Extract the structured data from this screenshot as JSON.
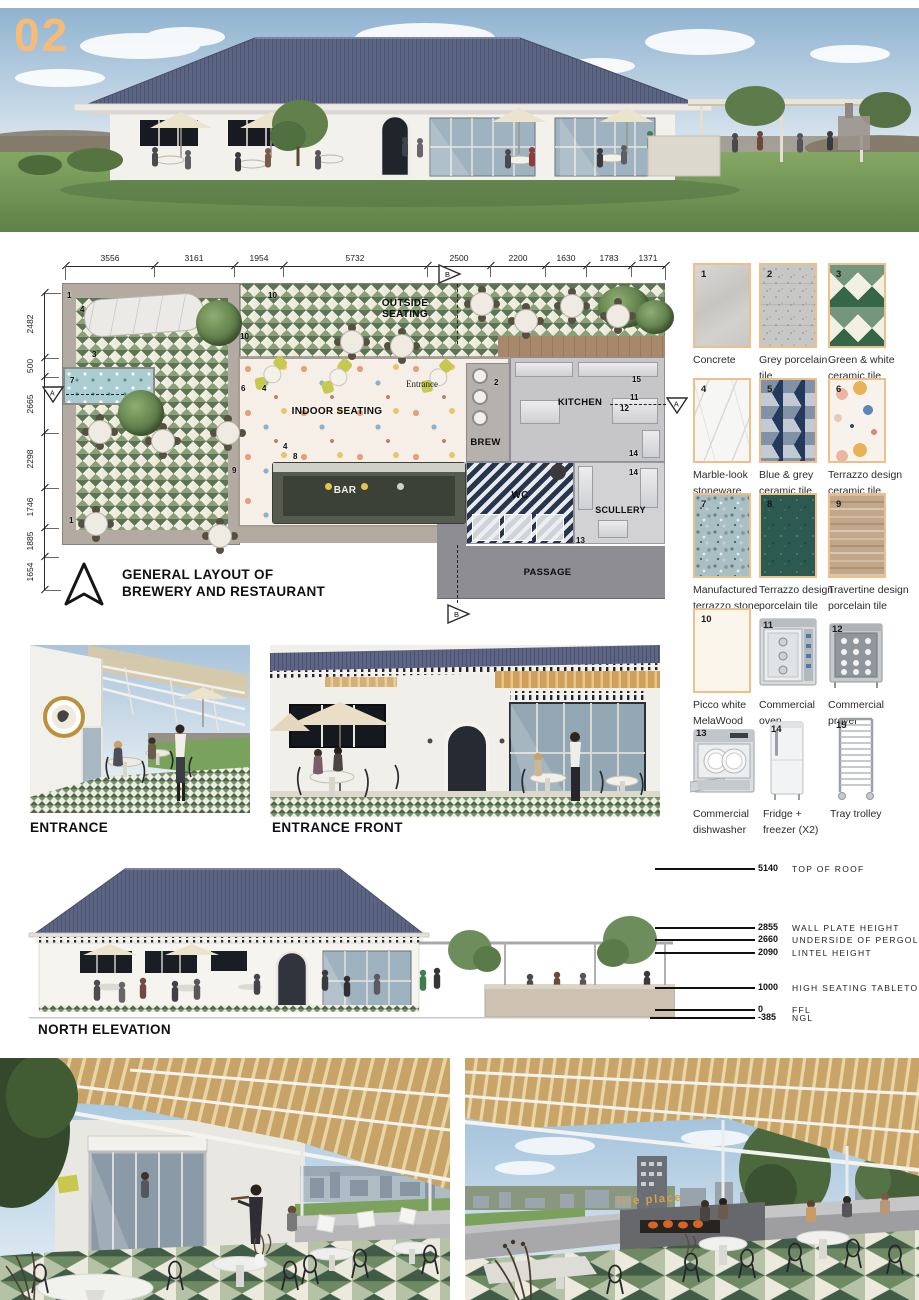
{
  "page": {
    "number": "02"
  },
  "colors": {
    "accent_orange": "#f6bb79",
    "swatch_border": "#ecbf8d",
    "roof_blue": "#5d6584",
    "tile_green": "#74906b",
    "gold_sign": "#d9a045"
  },
  "icons": {
    "north_arrow": "north-arrow-icon",
    "section_marker": "section-flag-icon"
  },
  "plan": {
    "title1": "GENERAL LAYOUT OF",
    "title2": "BREWERY AND RESTAURANT",
    "dims_top": [
      "3556",
      "3161",
      "1954",
      "5732",
      "2500",
      "2200",
      "1630",
      "1783",
      "1371"
    ],
    "dims_left": [
      "2482",
      "500",
      "2665",
      "2298",
      "1746",
      "1885",
      "1654"
    ],
    "labels": {
      "outside1": "OUTSIDE",
      "outside2": "SEATING",
      "indoor": "INDOOR SEATING",
      "bar": "BAR",
      "entrance": "Entrance",
      "brew": "BREW",
      "kitchen": "KITCHEN",
      "wc": "WC",
      "scullery": "SCULLERY",
      "passage": "PASSAGE"
    },
    "section_a": "A",
    "section_b": "B",
    "markers": [
      "1",
      "4",
      "3",
      "7",
      "10",
      "10",
      "6",
      "4",
      "9",
      "1",
      "4",
      "8",
      "2",
      "15",
      "11",
      "12",
      "14",
      "14",
      "13"
    ]
  },
  "materials": [
    {
      "num": "1",
      "line1": "Concrete",
      "line2": ""
    },
    {
      "num": "2",
      "line1": "Grey porcelain",
      "line2": "tile"
    },
    {
      "num": "3",
      "line1": "Green & white",
      "line2": "ceramic tile"
    },
    {
      "num": "4",
      "line1": "Marble-look",
      "line2": "stoneware"
    },
    {
      "num": "5",
      "line1": "Blue & grey",
      "line2": "ceramic tile"
    },
    {
      "num": "6",
      "line1": "Terrazzo design",
      "line2": "ceramic tile"
    },
    {
      "num": "7",
      "line1": "Manufactured",
      "line2": "terrazzo stone"
    },
    {
      "num": "8",
      "line1": "Terrazzo design",
      "line2": "porcelain tile"
    },
    {
      "num": "9",
      "line1": "Travertine design",
      "line2": "porcelain tile"
    },
    {
      "num": "10",
      "line1": "Picco white",
      "line2": "MelaWood"
    },
    {
      "num": "11",
      "line1": "Commercial",
      "line2": "oven"
    },
    {
      "num": "12",
      "line1": "Commercial",
      "line2": "prover"
    },
    {
      "num": "13",
      "line1": "Commercial",
      "line2": "dishwasher"
    },
    {
      "num": "14",
      "line1": "Fridge +",
      "line2": "freezer (X2)"
    },
    {
      "num": "15",
      "line1": "Tray trolley",
      "line2": ""
    }
  ],
  "views": {
    "entrance": "ENTRANCE",
    "entrance_front": "ENTRANCE FRONT",
    "north_elevation": "NORTH ELEVATION",
    "fire_place_sign": "fire place"
  },
  "elevation_levels": [
    {
      "value": "5140",
      "label": "TOP OF ROOF"
    },
    {
      "value": "2855",
      "label": "WALL PLATE HEIGHT"
    },
    {
      "value": "2660",
      "label": "UNDERSIDE OF PERGOLA"
    },
    {
      "value": "2090",
      "label": "LINTEL HEIGHT"
    },
    {
      "value": "1000",
      "label": "HIGH SEATING TABLETOP"
    },
    {
      "value": "0",
      "label": "FFL"
    },
    {
      "value": "-385",
      "label": "NGL"
    }
  ]
}
